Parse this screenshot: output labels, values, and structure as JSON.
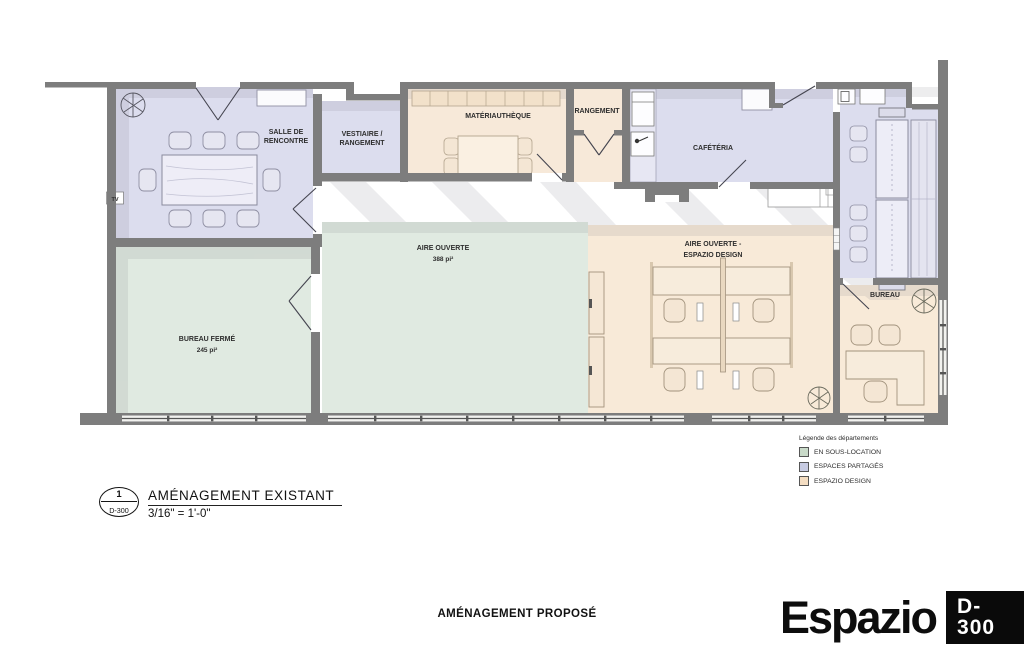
{
  "plan": {
    "rooms": {
      "salle_de_rencontre": {
        "line1": "SALLE DE",
        "line2": "RENCONTRE"
      },
      "vestiaire": {
        "line1": "VESTIAIRE /",
        "line2": "RANGEMENT"
      },
      "materiautheque": {
        "label": "MATÉRIAUTHÈQUE"
      },
      "rangement": {
        "label": "RANGEMENT"
      },
      "cafeteria": {
        "label": "CAFÉTÉRIA"
      },
      "aire_ouverte": {
        "line1": "AIRE OUVERTE",
        "line2": "388 pi²"
      },
      "espazio_design": {
        "line1": "AIRE OUVERTE -",
        "line2": "ESPAZIO DESIGN"
      },
      "bureau_ferme": {
        "line1": "BUREAU FERMÉ",
        "line2": "245 pi²"
      },
      "bureau": {
        "label": "BUREAU"
      },
      "tv": {
        "label": "TV"
      }
    }
  },
  "colors": {
    "sous_location": "#e0eae1",
    "partages": "#dcddee",
    "espazio": "#f8ead8",
    "espazio_room": "#f7e9d9",
    "wall": "#7d7d7d"
  },
  "legend": {
    "title": "Légende des départements",
    "items": [
      {
        "label": "EN SOUS-LOCATION",
        "color": "#c9dac9"
      },
      {
        "label": "ESPACES PARTAGÉS",
        "color": "#c7cbe2"
      },
      {
        "label": "ESPAZIO DESIGN",
        "color": "#f4ddc2"
      }
    ]
  },
  "title_block": {
    "number": "1",
    "sheet": "D-300",
    "title": "AMÉNAGEMENT EXISTANT",
    "scale": "3/16\" = 1'-0\""
  },
  "footer": {
    "caption": "AMÉNAGEMENT PROPOSÉ",
    "logo": "Espazio",
    "sheet_number": "D-300"
  }
}
